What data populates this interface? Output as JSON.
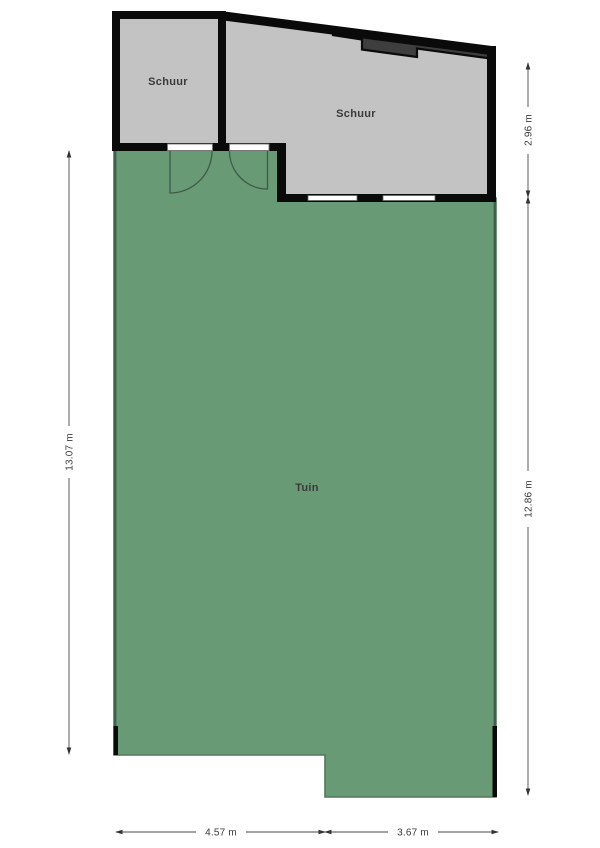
{
  "document": {
    "type": "garden floor plan",
    "background": "#ffffff"
  },
  "rooms": {
    "shed_left": {
      "label": "Schuur"
    },
    "shed_right": {
      "label": "Schuur"
    },
    "garden": {
      "label": "Tuin"
    }
  },
  "dimensions": {
    "left_height": "13.07 m",
    "right_shed_height": "2.96 m",
    "right_garden_height": "12.86 m",
    "bottom_left_width": "4.57 m",
    "bottom_right_width": "3.67 m"
  },
  "colors": {
    "garden_fill": "#689a76",
    "garden_edge": "#3f6049",
    "shed_fill": "#c3c3c3",
    "wall": "#0a0a0a",
    "roof_band": "#3e3e3e",
    "dimension_text": "#3a3a3a"
  }
}
